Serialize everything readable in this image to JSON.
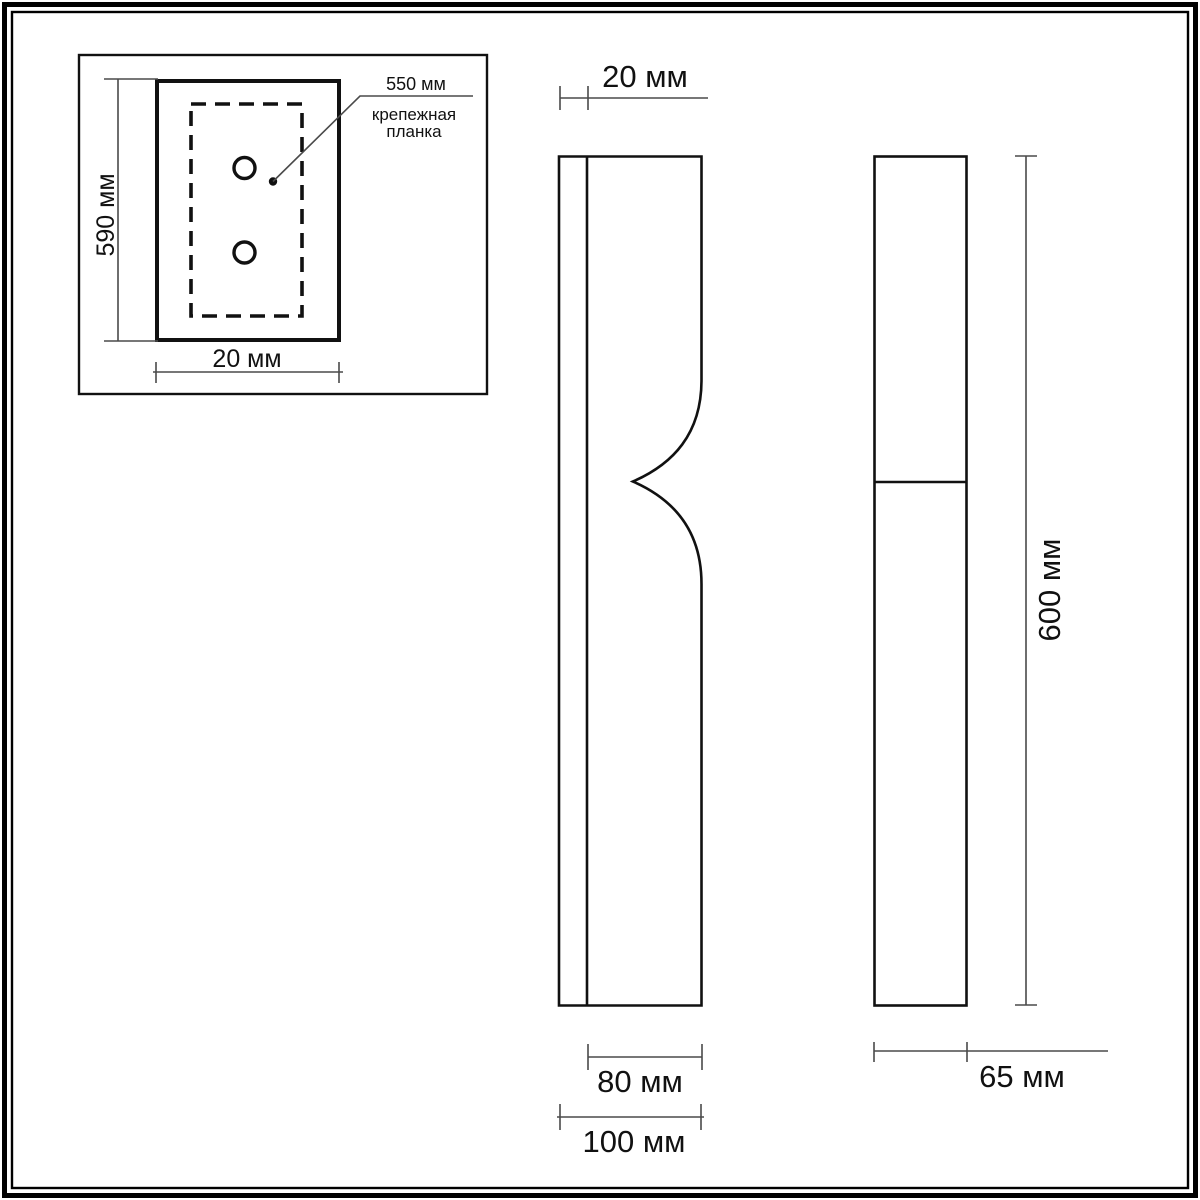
{
  "colors": {
    "background": "#ffffff",
    "object_line": "#111111",
    "dimension_line": "#4a4a4a",
    "text": "#111111"
  },
  "inset": {
    "height_dim": "590 мм",
    "width_dim": "20 мм",
    "plate_length_dim": "550 мм",
    "plate_label_line1": "крепежная",
    "plate_label_line2": "планка"
  },
  "front_view": {
    "back_depth_dim": "20 мм",
    "body_width_dim": "80 мм",
    "overall_width_dim": "100 мм"
  },
  "side_view": {
    "height_dim": "600 мм",
    "depth_dim": "65 мм"
  }
}
